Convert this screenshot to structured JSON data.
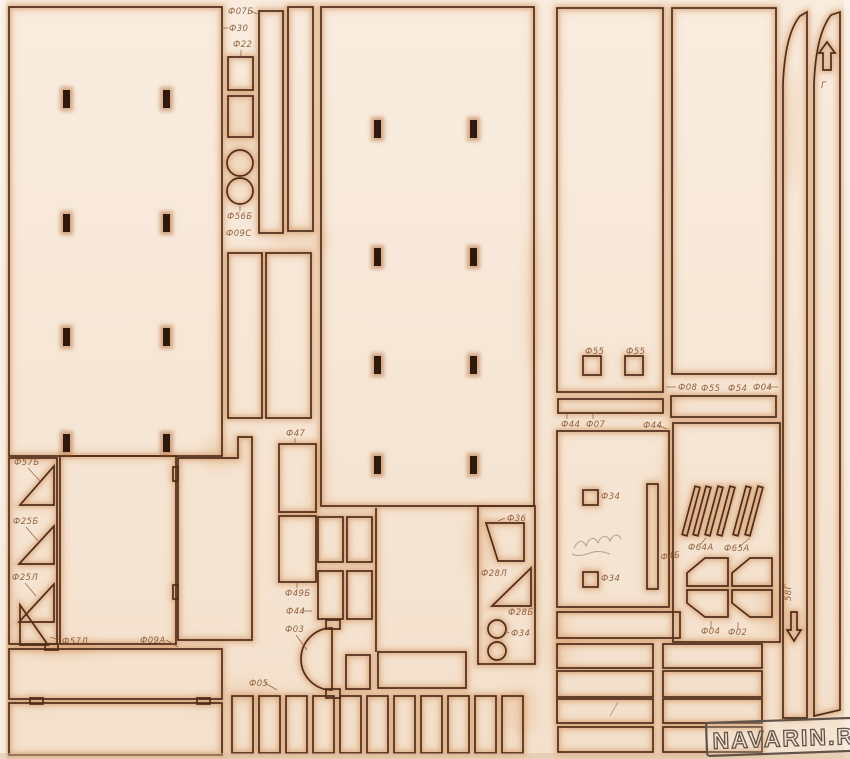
{
  "palette": {
    "paper_top": "#f9ecdf",
    "paper_bottom": "#f4e1cd",
    "cut_line": "#4f2d1b",
    "scorch": "#c9854f",
    "scorch_halo": "#dba06a",
    "hole": "#2f180c",
    "label_ink": "#8a5736",
    "pencil": "#a6988a",
    "watermark_ink": "#615349"
  },
  "watermark": {
    "text": "NAVARIN.RU"
  },
  "labels": [
    {
      "text": "Ф07Б",
      "x": 228,
      "y": 14,
      "line": [
        251,
        11,
        257,
        14
      ]
    },
    {
      "text": "Ф30",
      "x": 229,
      "y": 31,
      "line": [
        221,
        28,
        228,
        28
      ]
    },
    {
      "text": "Ф22",
      "x": 233,
      "y": 47,
      "line": [
        241,
        50,
        241,
        56
      ]
    },
    {
      "text": "Ф56Б",
      "x": 227,
      "y": 219,
      "line": [
        240,
        211,
        240,
        205
      ]
    },
    {
      "text": "Ф09С",
      "x": 226,
      "y": 236
    },
    {
      "text": "Ф57Б",
      "x": 14,
      "y": 465,
      "line": [
        28,
        468,
        40,
        481
      ]
    },
    {
      "text": "Ф25Б",
      "x": 13,
      "y": 524,
      "line": [
        26,
        527,
        38,
        541
      ]
    },
    {
      "text": "Ф25Л",
      "x": 12,
      "y": 580,
      "line": [
        25,
        583,
        36,
        596
      ]
    },
    {
      "text": "Ф57Л",
      "x": 62,
      "y": 644,
      "line": [
        60,
        640,
        50,
        637
      ]
    },
    {
      "text": "Ф09А",
      "x": 140,
      "y": 643,
      "line": [
        166,
        640,
        178,
        647
      ]
    },
    {
      "text": "Ф47",
      "x": 286,
      "y": 436,
      "line": [
        295,
        438,
        295,
        444
      ]
    },
    {
      "text": "Ф49Б",
      "x": 285,
      "y": 596,
      "line": [
        297,
        588,
        297,
        583
      ]
    },
    {
      "text": "Ф44",
      "x": 286,
      "y": 614,
      "line": [
        302,
        611,
        312,
        611
      ]
    },
    {
      "text": "Ф03",
      "x": 285,
      "y": 632,
      "line": [
        296,
        635,
        307,
        650
      ]
    },
    {
      "text": "Ф05",
      "x": 249,
      "y": 686,
      "line": [
        265,
        683,
        277,
        690
      ]
    },
    {
      "text": "Ф36",
      "x": 507,
      "y": 521,
      "line": [
        505,
        518,
        498,
        521
      ]
    },
    {
      "text": "Ф28Л",
      "x": 481,
      "y": 576
    },
    {
      "text": "Ф28Б",
      "x": 508,
      "y": 615
    },
    {
      "text": "Ф34",
      "x": 511,
      "y": 636,
      "line": [
        509,
        633,
        505,
        631
      ]
    },
    {
      "text": "Ф55",
      "x": 585,
      "y": 354
    },
    {
      "text": "Ф55",
      "x": 626,
      "y": 354
    },
    {
      "text": "Ф08",
      "x": 678,
      "y": 390,
      "line": [
        666,
        387,
        676,
        387
      ]
    },
    {
      "text": "Ф55",
      "x": 701,
      "y": 391
    },
    {
      "text": "Ф54",
      "x": 728,
      "y": 391
    },
    {
      "text": "Ф04",
      "x": 753,
      "y": 390,
      "line": [
        768,
        387,
        778,
        387
      ]
    },
    {
      "text": "Ф44",
      "x": 561,
      "y": 427,
      "line": [
        567,
        419,
        567,
        414
      ]
    },
    {
      "text": "Ф07",
      "x": 586,
      "y": 427,
      "line": [
        593,
        419,
        593,
        414
      ]
    },
    {
      "text": "Ф44",
      "x": 643,
      "y": 428,
      "line": [
        657,
        425,
        667,
        429
      ]
    },
    {
      "text": "Ф34",
      "x": 601,
      "y": 499
    },
    {
      "text": "Ф34",
      "x": 601,
      "y": 581
    },
    {
      "text": "Ф4Б",
      "x": 661,
      "y": 560,
      "rot": -8
    },
    {
      "text": "Ф64А",
      "x": 688,
      "y": 550,
      "line": [
        700,
        545,
        706,
        538
      ]
    },
    {
      "text": "Ф65А",
      "x": 724,
      "y": 551,
      "line": [
        740,
        546,
        750,
        538
      ]
    },
    {
      "text": "Ф04",
      "x": 701,
      "y": 634,
      "line": [
        711,
        629,
        711,
        621
      ]
    },
    {
      "text": "Ф02",
      "x": 728,
      "y": 635,
      "line": [
        738,
        630,
        738,
        622
      ]
    },
    {
      "text": "58Г",
      "x": 791,
      "y": 601,
      "rot": -90
    },
    {
      "text": "Г",
      "x": 821,
      "y": 88
    }
  ]
}
